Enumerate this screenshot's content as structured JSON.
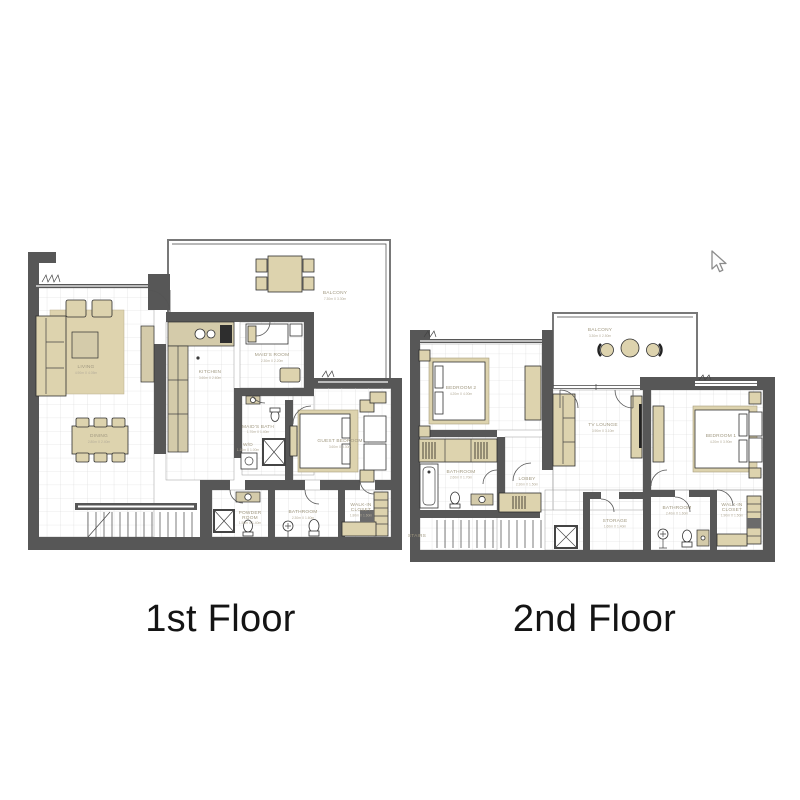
{
  "page": {
    "background": "#ffffff"
  },
  "floor1": {
    "label": "1st Floor",
    "rooms": {
      "balcony": {
        "name": "BALCONY",
        "dims": "7.30m X 3.30m"
      },
      "living": {
        "name": "LIVING",
        "dims": "4.90m X 4.05m"
      },
      "dining": {
        "name": "DINING",
        "dims": "2.80m X 2.40m"
      },
      "kitchen": {
        "name": "KITCHEN",
        "dims": "3.60m X 2.60m"
      },
      "maids_room": {
        "name": "MAID'S ROOM",
        "dims": "2.30m X 2.20m"
      },
      "maids_bath": {
        "name": "MAID'S BATH",
        "dims": "1.70m X 1.40m"
      },
      "wd": {
        "name": "W/D",
        "dims": "1.10m X 1.00m"
      },
      "guest_bedroom": {
        "name": "GUEST BEDROOM",
        "dims": "3.60m X 3.30m"
      },
      "powder_room": {
        "line1": "POWDER",
        "line2": "ROOM",
        "dims": "1.50m X 1.40m"
      },
      "bathroom": {
        "name": "BATHROOM",
        "dims": "2.30m X 1.60m"
      },
      "walkin_closet": {
        "line1": "WALK-IN",
        "line2": "CLOSET",
        "dims": "1.80m X 1.60m"
      }
    }
  },
  "floor2": {
    "label": "2nd Floor",
    "rooms": {
      "balcony": {
        "name": "BALCONY",
        "dims": "3.30m X 2.50m"
      },
      "bedroom2": {
        "name": "BEDROOM 2",
        "dims": "4.20m X 4.00m"
      },
      "tv_lounge": {
        "name": "TV LOUNGE",
        "dims": "3.90m X 3.10m"
      },
      "bedroom1": {
        "name": "BEDROOM 1",
        "dims": "4.20m X 3.90m"
      },
      "bathroom": {
        "name": "BATHROOM",
        "dims": "2.60m X 1.70m"
      },
      "lobby": {
        "name": "LOBBY",
        "dims": "2.30m X 1.50m"
      },
      "stairs": {
        "name": "STAIRS"
      },
      "storage": {
        "name": "STORAGE",
        "dims": "1.60m X 1.40m"
      },
      "bathroom2": {
        "name": "BATHROOM",
        "dims": "2.40m X 1.60m"
      },
      "walkin_closet": {
        "line1": "WALK-IN",
        "line2": "CLOSET",
        "dims": "1.90m X 1.50m"
      }
    }
  },
  "colors": {
    "wall": "#575757",
    "furniture": "#ddd3ae",
    "grid": "#d8d8d8",
    "room_label": "#a09880",
    "title": "#141414"
  }
}
